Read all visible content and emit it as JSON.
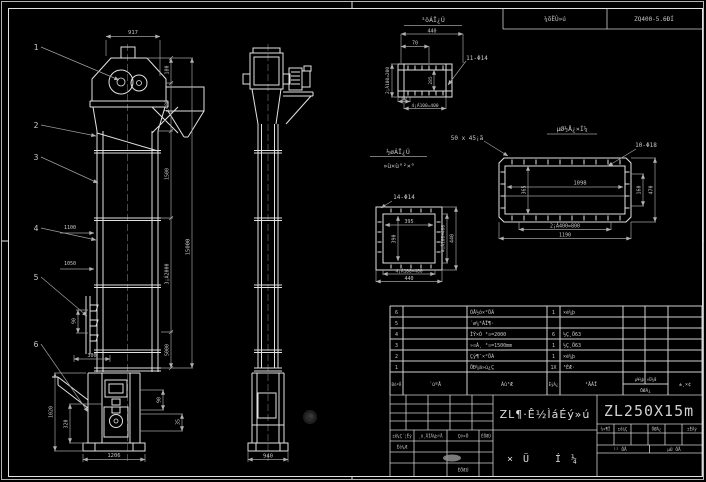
{
  "colors": {
    "background": "#000000",
    "line": "#e2e2e2",
    "dim_line": "#9f9f9f",
    "text": "#c8c8c8",
    "signature_blob": "#8f8f8f"
  },
  "top_strip": {
    "reducer_label": "¼õËÙ»ú",
    "reducer_model": "ZQ400-5.6ÐÍ"
  },
  "balloons": [
    "1",
    "2",
    "3",
    "4",
    "5",
    "6"
  ],
  "front_view": {
    "dim_head_width": "917",
    "dim_180": "180",
    "dim_1480": "1480",
    "dim_1500": "1500",
    "dim_3x2000": "3¡Á2000",
    "dim_5000": "5000",
    "dim_total_height": "15000",
    "note_1100": "1100",
    "note_1050": "1050",
    "dim_90": "90",
    "dim_300": "300",
    "dim_boot_h": "1020",
    "dim_320": "320",
    "dim_boot_w": "1206",
    "dim_90b": "90",
    "dim_35": "35"
  },
  "side_view": {
    "dim_base": "940"
  },
  "detail_outlet": {
    "title": "³öÁÏ¿Ú",
    "dim_440": "440",
    "dim_70": "70",
    "dim_left": "2¡Á100=200",
    "dim_inner": "285",
    "holes": "11-Φ14",
    "dim_40": "40",
    "dim_bottom": "4¡Á100=400"
  },
  "detail_inlet": {
    "title_line1": "½øÁÏ¿Ú",
    "title_line2": "»ù×ù°²×°",
    "holes": "14-Φ14",
    "dim_inner_w": "395",
    "dim_inner_h": "390",
    "dim_right1": "4¡Á100=400",
    "dim_right2": "440",
    "dim_bottom1": "4¡Á100=400",
    "dim_bottom2": "440"
  },
  "detail_base": {
    "title": "µØ½Å¿×Í¼",
    "chamfer_note": "50 x 45¡ã",
    "holes": "10-Φ18",
    "dim_inner": "1098",
    "dim_left": "365",
    "dim_right1": "160",
    "dim_right2": "470",
    "dim_bottom1": "2¡Á400=800",
    "dim_bottom2": "1190"
  },
  "bom": {
    "headers": {
      "no": "ÐòºÅ",
      "code": "´úºÅ",
      "name": "Ãû³Æ",
      "qty": "ÊýÁ¿",
      "material": "²ÄÁÏ",
      "weight_split": "µ¥¼þ ×Ü¼Æ",
      "weight": "ÖØÁ¿",
      "remarks": "±¸×¢"
    },
    "rows": [
      {
        "no": "6",
        "code": "",
        "name": "ÕÅ½ô×°ÖÃ",
        "qty": "1",
        "material": "×é¼þ"
      },
      {
        "no": "5",
        "code": "",
        "name": "´ø¼°ÁÏ¶·",
        "qty": "",
        "material": ""
      },
      {
        "no": "4",
        "code": "",
        "name": "ÌÝ×Ó ³¤=2000",
        "qty": "6",
        "material": "½Ç¸Ö63"
      },
      {
        "no": "3",
        "code": "",
        "name": "»¤À¸ ³¤=1500mm",
        "qty": "1",
        "material": "½Ç¸Ö63"
      },
      {
        "no": "2",
        "code": "",
        "name": "Çý¶¯×°ÖÃ",
        "qty": "1",
        "material": "×é¼þ"
      },
      {
        "no": "1",
        "code": "",
        "name": "ÖÐ¼ä»ú¿Ç",
        "qty": "1X",
        "material": "³ÉÆ·"
      }
    ]
  },
  "title_block": {
    "rev_header_1": "±ê¼Ç´¦Êý",
    "rev_header_2": "¸ü¸ÄÎÄ¼þºÅ",
    "rev_header_3": "Ç©×Ö",
    "rev_header_4": "ÈÕÆÚ",
    "design_label": "Éè¼Æ",
    "date_label": "ÈÕÆÚ",
    "title": "ZL¶·Ê½ÌáÉý»ú",
    "type_label": "×Ü Í¼",
    "drawing_no": "ZL250X15m",
    "stage_1": "½×¶Î",
    "stage_2": "±ê¼Ç",
    "stage_3": "ÖØÁ¿",
    "stage_4": "±ÈÀý",
    "sheet_total": "¹² ÕÅ",
    "sheet_index": "µÚ ÕÅ"
  }
}
